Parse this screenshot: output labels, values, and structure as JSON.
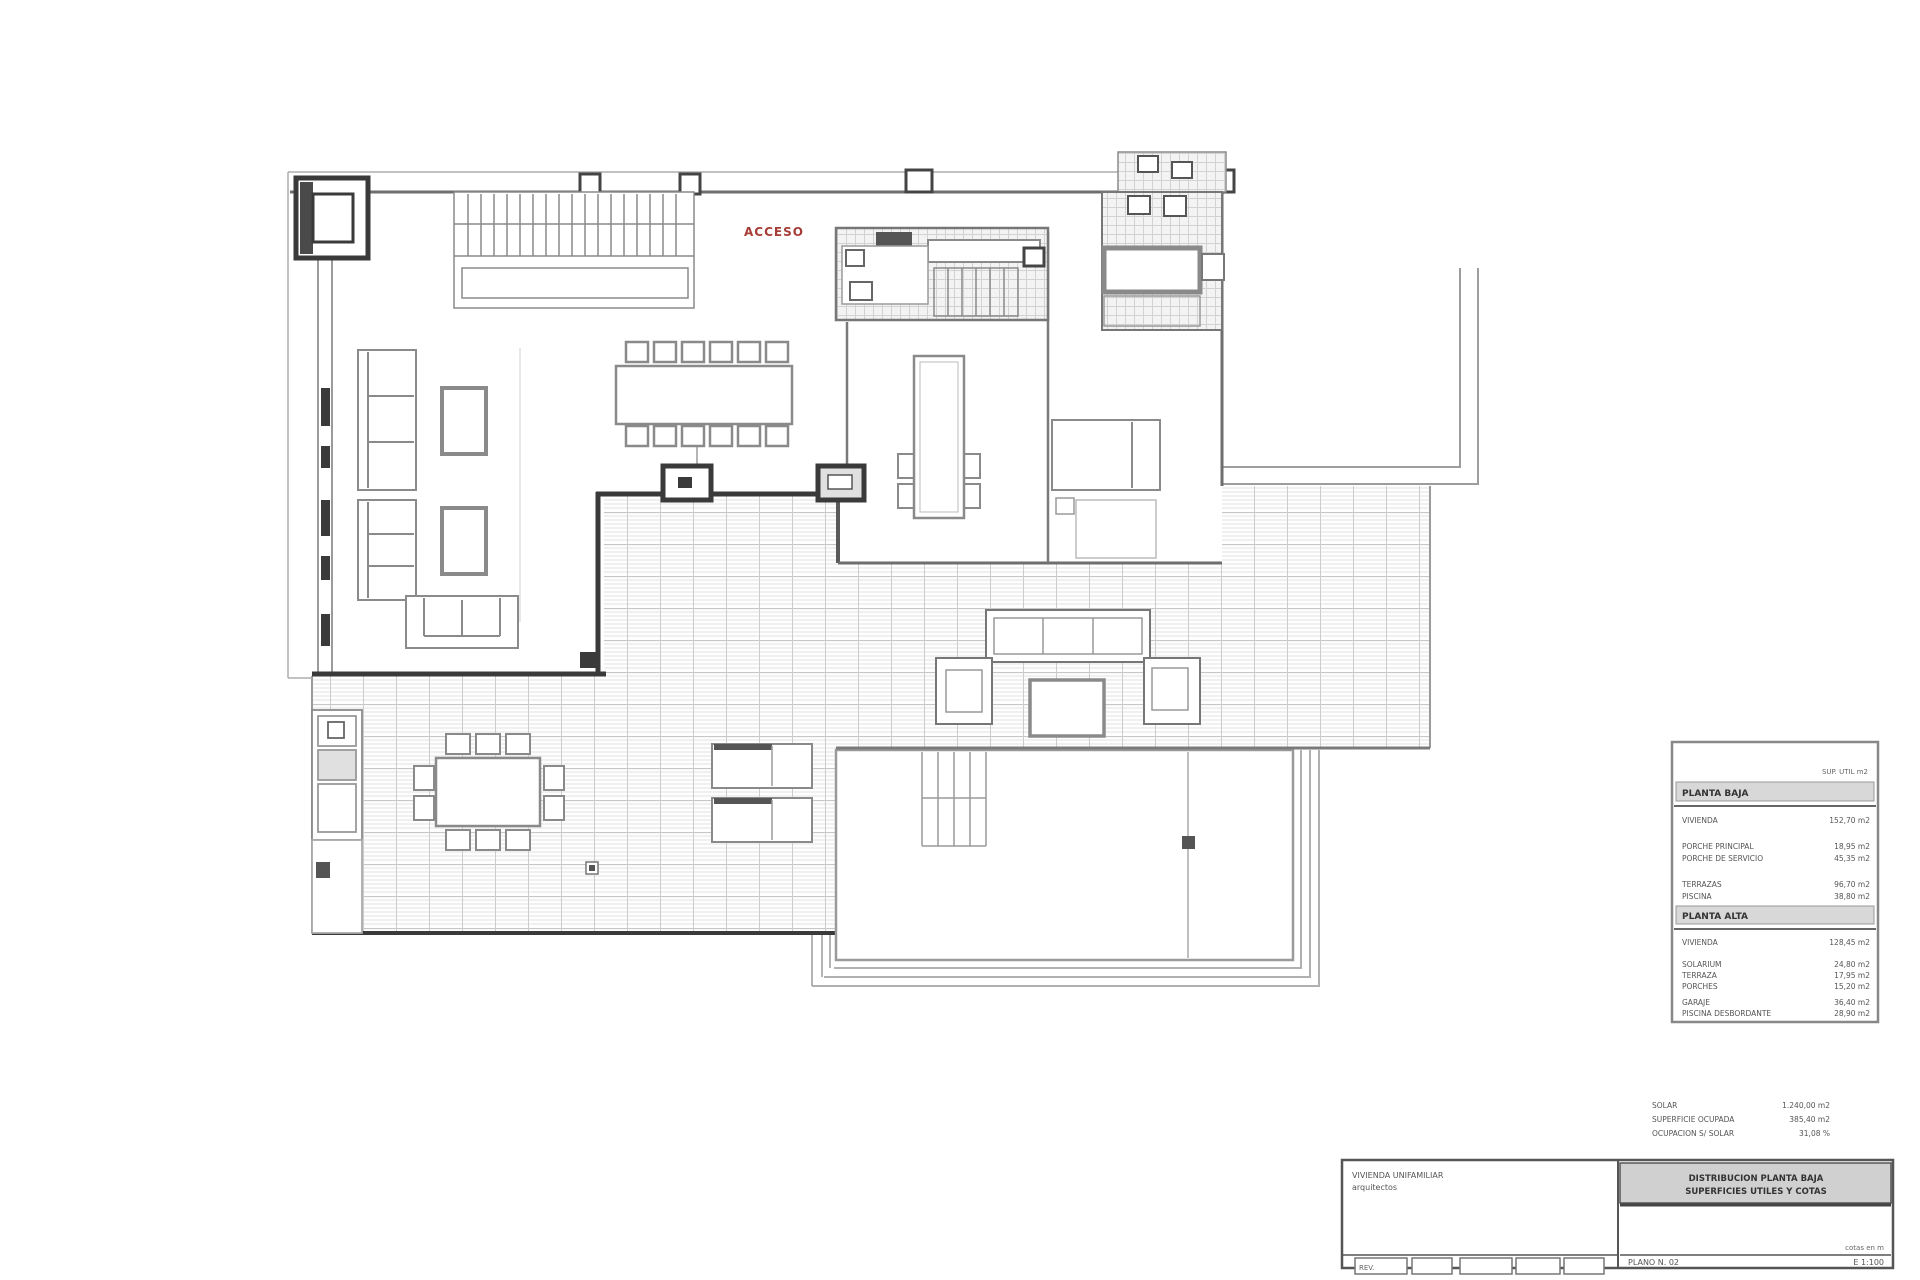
{
  "plan": {
    "red_label": "ACCESO"
  },
  "legend": {
    "note": "SUP. UTIL m2",
    "sections": [
      {
        "header": "PLANTA BAJA",
        "rows": [
          {
            "label": "VIVIENDA",
            "value": "152,70 m2"
          },
          {
            "label": "PORCHE PRINCIPAL",
            "value": "18,95 m2"
          },
          {
            "label": "PORCHE DE SERVICIO",
            "value": "45,35 m2"
          },
          {
            "label": "TERRAZAS",
            "value": "96,70 m2"
          },
          {
            "label": "PISCINA",
            "value": "38,80 m2"
          }
        ]
      },
      {
        "header": "PLANTA ALTA",
        "rows": [
          {
            "label": "VIVIENDA",
            "value": "128,45 m2"
          },
          {
            "label": "SOLARIUM",
            "value": "24,80 m2"
          },
          {
            "label": "TERRAZA",
            "value": "17,95 m2"
          },
          {
            "label": "PORCHES",
            "value": "15,20 m2"
          },
          {
            "label": "GARAJE",
            "value": "36,40 m2"
          },
          {
            "label": "PISCINA DESBORDANTE",
            "value": "28,90 m2"
          }
        ]
      }
    ]
  },
  "summary": {
    "rows": [
      {
        "label": "SOLAR",
        "value": "1.240,00 m2"
      },
      {
        "label": "SUPERFICIE OCUPADA",
        "value": "385,40 m2"
      },
      {
        "label": "OCUPACION S/ SOLAR",
        "value": "31,08 %"
      }
    ]
  },
  "titleblock": {
    "project_line1": "VIVIENDA UNIFAMILIAR",
    "project_line2": "arquitectos",
    "sheet_title_line1": "DISTRIBUCION PLANTA BAJA",
    "sheet_title_line2": "SUPERFICIES UTILES Y COTAS",
    "note": "cotas en m",
    "sheet_number": "PLANO N. 02",
    "scale": "E 1:100",
    "rev_box_label": "REV."
  }
}
